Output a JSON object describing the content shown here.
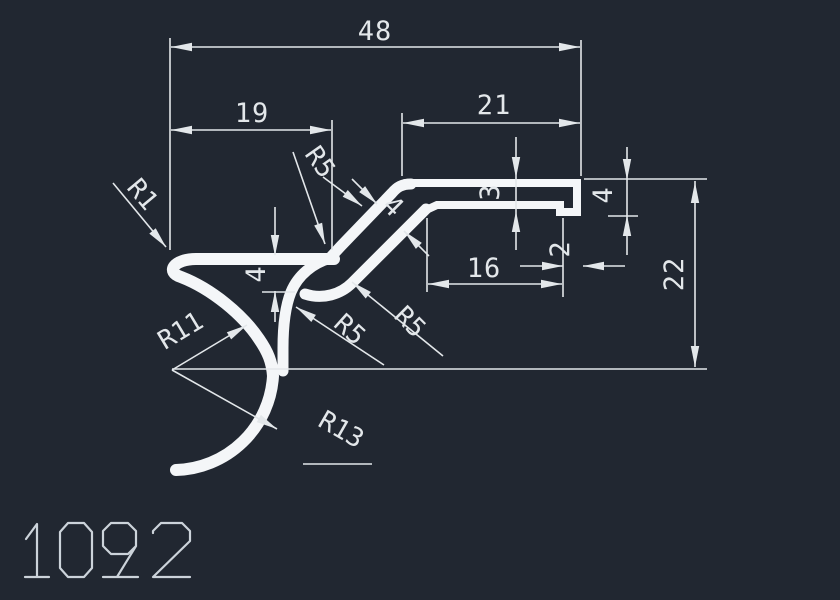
{
  "title": "1092",
  "dims": {
    "total_width": "48",
    "left_width": "19",
    "right_width": "21",
    "slot_width": "16",
    "plate_thickness": "3",
    "step_width": "2",
    "lip_height": "4",
    "total_height": "22",
    "flange_height": "4",
    "wall_thickness": "4"
  },
  "radii": {
    "r1": "R1",
    "r5_top": "R5",
    "r5_mid": "R5",
    "r5_low": "R5",
    "r11": "R11",
    "r13": "R13"
  },
  "colors": {
    "background": "#212731",
    "profile": "#f4f6f8",
    "dimension": "#e3e7ea",
    "title": "#ccd3da"
  }
}
